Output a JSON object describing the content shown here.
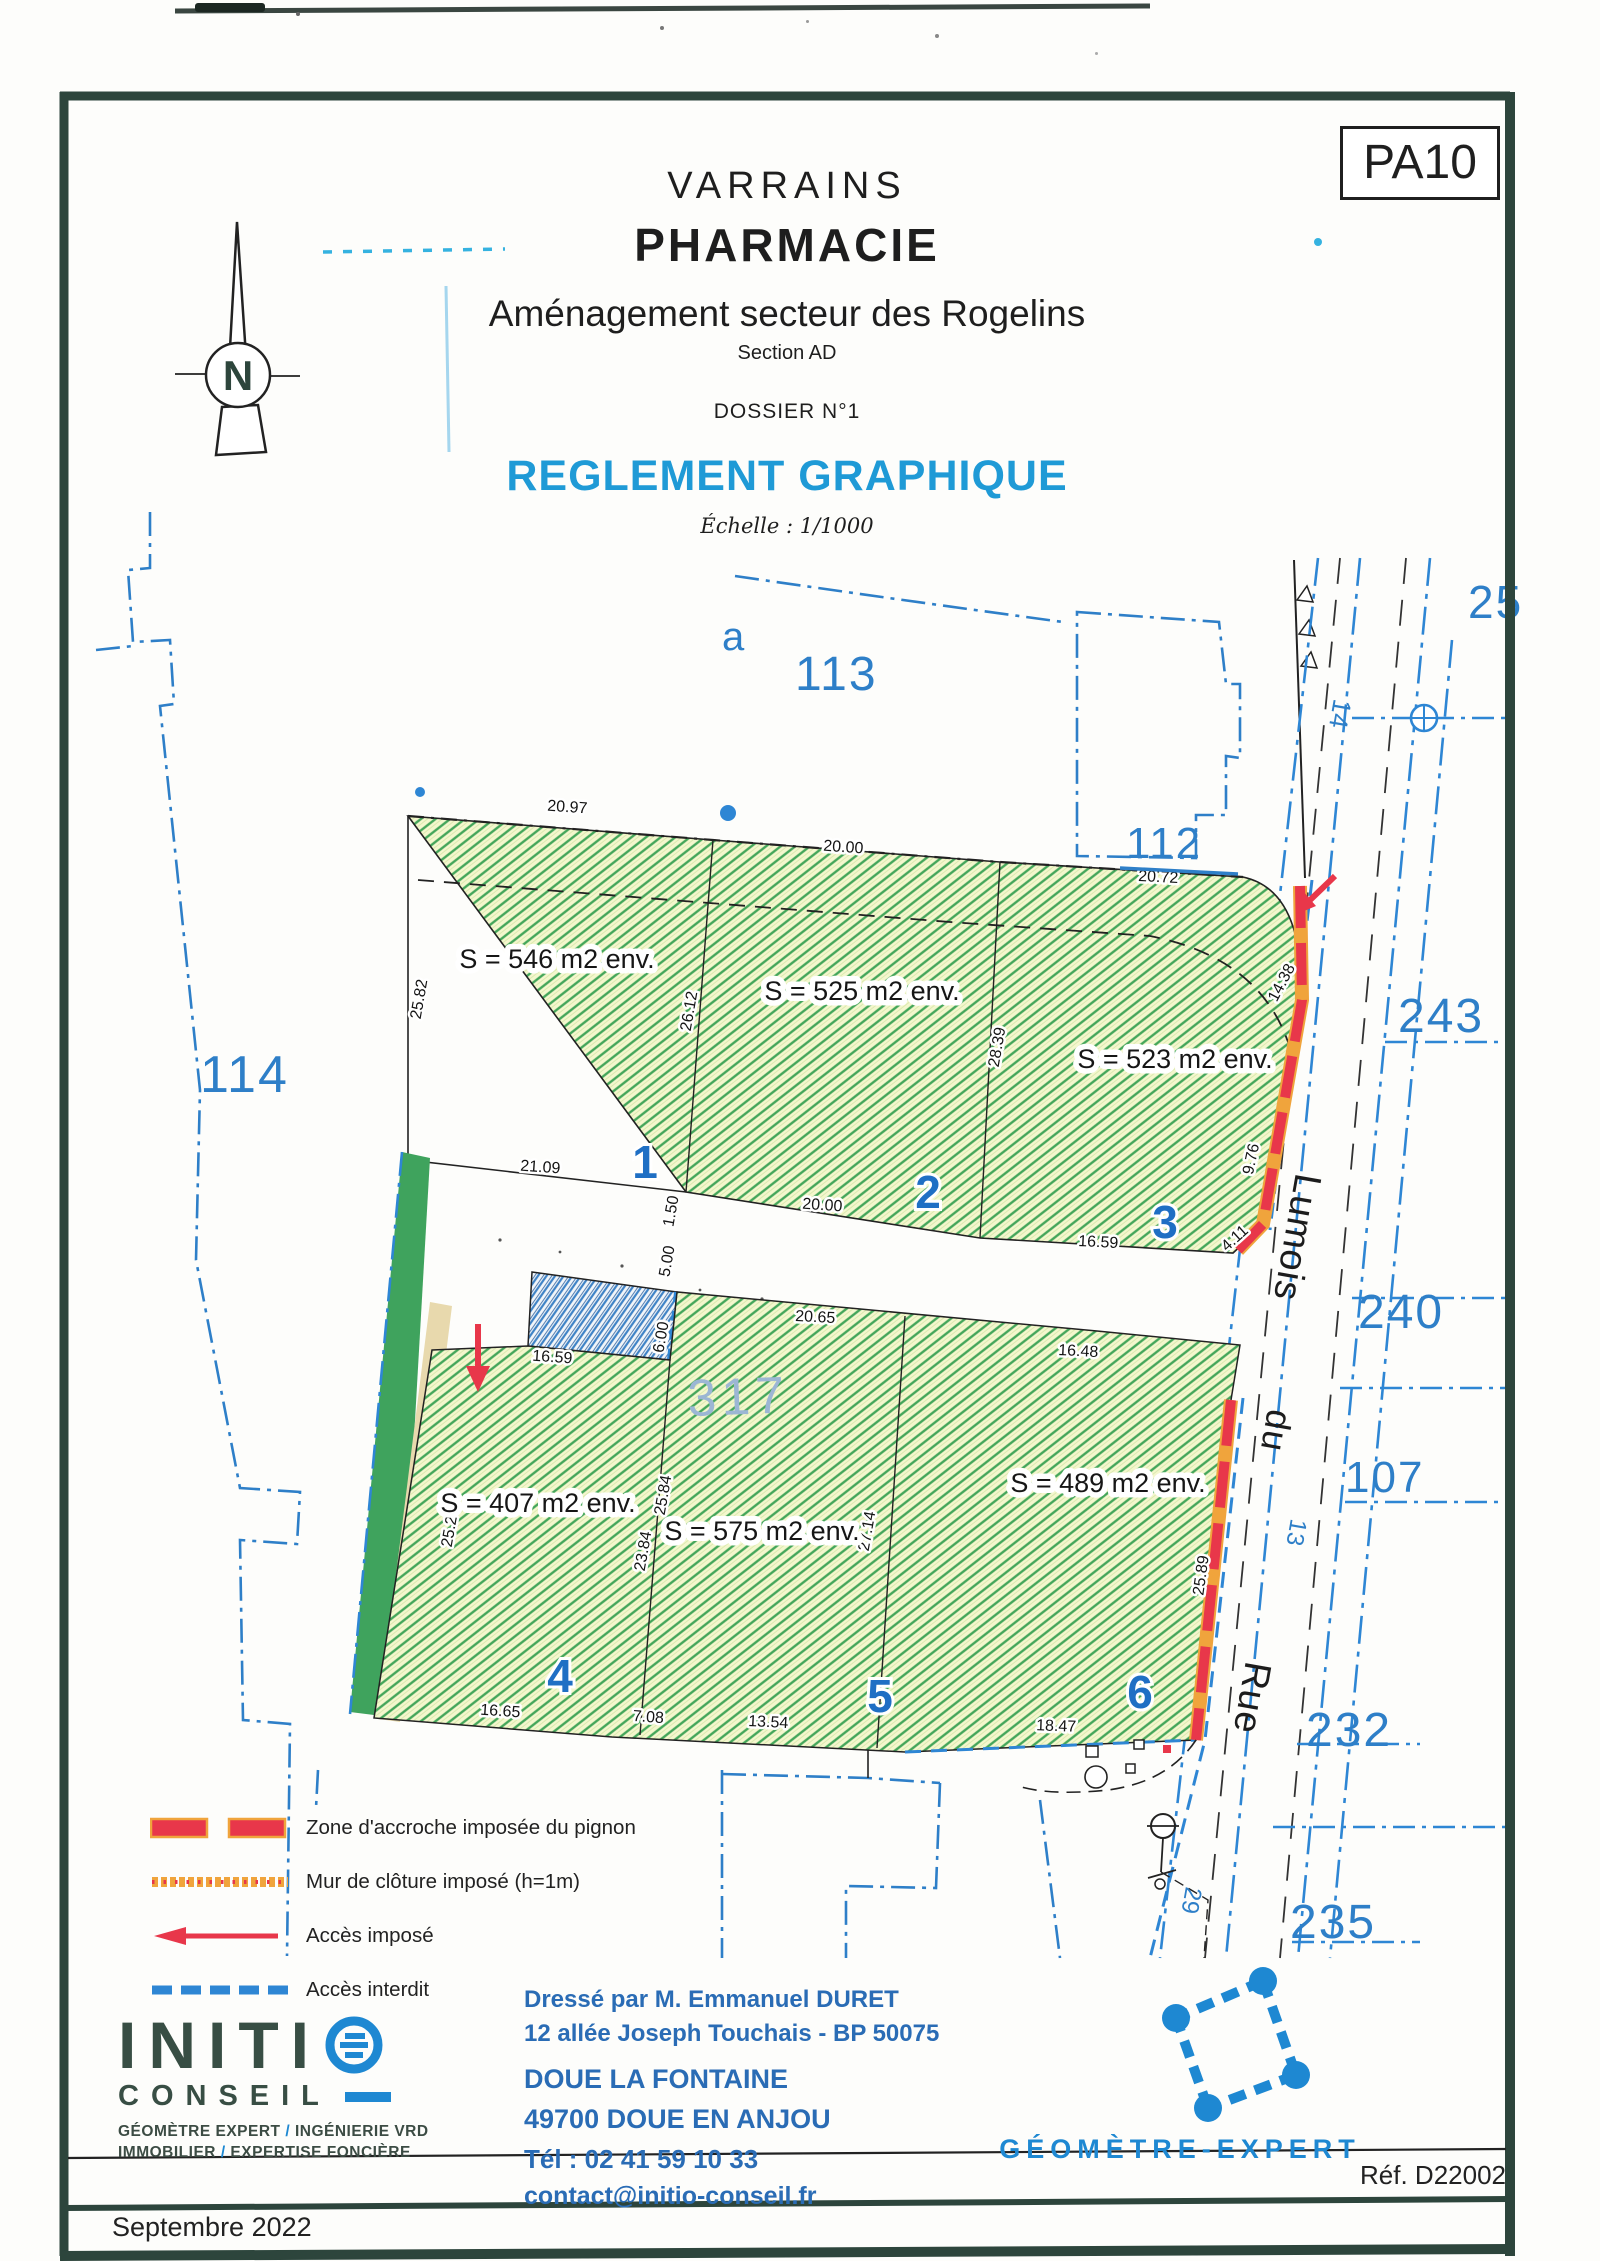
{
  "frame": {
    "code": "PA10"
  },
  "header": {
    "commune": "VARRAINS",
    "project": "PHARMACIE",
    "subtitle": "Aménagement secteur des Rogelins",
    "section": "Section AD",
    "dossier": "DOSSIER N°1",
    "doc_title": "REGLEMENT GRAPHIQUE",
    "scale": "Échelle : 1/1000"
  },
  "compass": {
    "north": "N"
  },
  "plan": {
    "parcels": {
      "a": "a",
      "n113": "113",
      "n114": "114",
      "n112": "112",
      "n25": "25",
      "n243": "243",
      "n240": "240",
      "n107": "107",
      "n232": "232",
      "n235": "235",
      "n317": "317"
    },
    "street": {
      "word_rue": "Rue",
      "word_du": "du",
      "word_lumois": "Lumois",
      "n14": "14",
      "n13": "13",
      "n29": "29"
    },
    "lots": [
      {
        "num": "1",
        "area": "S = 546 m2 env."
      },
      {
        "num": "2",
        "area": "S = 525 m2 env."
      },
      {
        "num": "3",
        "area": "S = 523 m2 env."
      },
      {
        "num": "4",
        "area": "S = 407 m2 env."
      },
      {
        "num": "5",
        "area": "S = 575 m2 env."
      },
      {
        "num": "6",
        "area": "S = 489 m2 env."
      }
    ],
    "dims": {
      "d2097": "20.97",
      "d2000a": "20.00",
      "d2072": "20.72",
      "d2582": "25.82",
      "d2612": "26.12",
      "d2839": "28.39",
      "d1438": "14.38",
      "d976": "9.76",
      "d2109": "21.09",
      "d2000b": "20.00",
      "d1659a": "16.59",
      "d411": "4.11",
      "d150": "1.50",
      "d500": "5.00",
      "d600": "6.00",
      "d1659b": "16.59",
      "d2065": "20.65",
      "d1648": "16.48",
      "d2524": "25.24",
      "d2384": "23.84",
      "d2584": "25.84",
      "d2714": "27.14",
      "d2589": "25.89",
      "d1665": "16.65",
      "d708": "7.08",
      "d1354": "13.54",
      "d1847": "18.47"
    }
  },
  "legend": {
    "items": [
      {
        "label": "Zone d'accroche imposée du pignon",
        "type": "red-dash"
      },
      {
        "label": "Mur de clôture imposé (h=1m)",
        "type": "orange-wall"
      },
      {
        "label": "Accès imposé",
        "type": "red-arrow"
      },
      {
        "label": "Accès interdit",
        "type": "blue-dash"
      }
    ]
  },
  "firm": {
    "name_main": "INITI",
    "name_sub": "CONSEIL",
    "slash": "/",
    "tag1a": "GÉOMÈTRE EXPERT ",
    "tag1b": " INGÉNIERIE VRD",
    "tag2a": "IMMOBILIER ",
    "tag2b": " EXPERTISE FONCIÈRE"
  },
  "author": {
    "line1": "Dressé par M. Emmanuel DURET",
    "line2": "12 allée Joseph Touchais - BP 50075",
    "line3": "DOUE LA FONTAINE",
    "line4": "49700 DOUE EN ANJOU",
    "line5": "Tél : 02 41 59 10 33",
    "line6": "contact@initio-conseil.fr"
  },
  "certif": {
    "label": "GÉOMÈTRE-EXPERT"
  },
  "footer": {
    "ref": "Réf. D22002",
    "date": "Septembre 2022"
  },
  "colors": {
    "frame": "#2d453c",
    "cadastral_blue": "#2e7fc8",
    "doc_blue": "#1f9ad6",
    "red": "#e8374a",
    "orange": "#f0a43c",
    "hatch_green": "#44a65a",
    "strip_green": "#3fa35d",
    "beige": "#e8d9ad",
    "author_blue": "#2a6cb5",
    "logo_blue": "#1e88d2"
  }
}
